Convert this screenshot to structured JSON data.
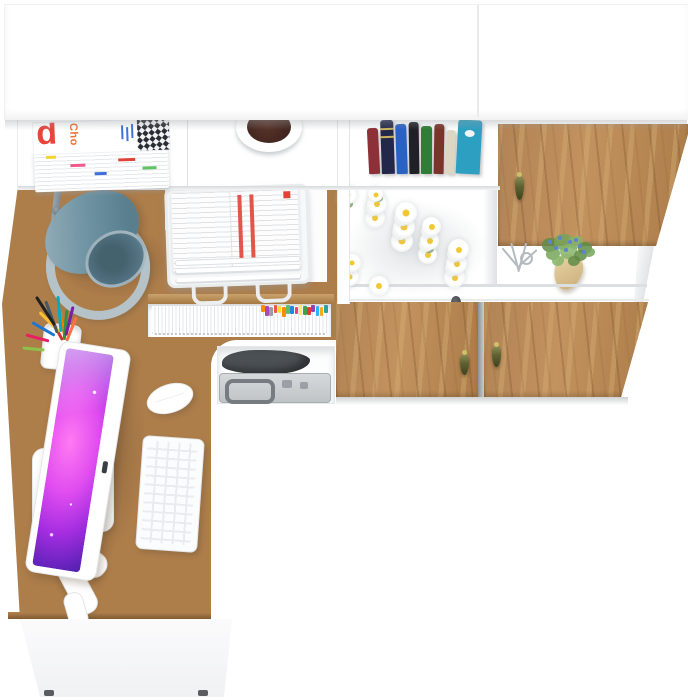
{
  "scene": {
    "background": "#ffffff",
    "floor": "#ffffff"
  },
  "palette": {
    "wood_base": "#ad7d4a",
    "wood_light": "#cda471",
    "wood_dark": "#8a5f33",
    "furniture_white": "#ffffff",
    "edge_gray": "#e3e6e8",
    "shadow_gray": "#c9cccf",
    "seam_dark": "#9b9ea1"
  },
  "magazines": {
    "big_letter": "d",
    "title_text": "Cho",
    "letter_color": "#e8443a",
    "title_color": "#ef6f2e",
    "fine_text_color": "#3f71d8",
    "checker_dark": "#2a2d33",
    "checker_light": "#f2f3f5",
    "edge_chip_colors": [
      "#f6d32d",
      "#ef5a8a",
      "#3f71d8",
      "#e04438",
      "#62c262"
    ]
  },
  "planter": {
    "pot_color": "#ffffff",
    "soil_color": "#46281f"
  },
  "books": {
    "spines": [
      {
        "color": "#8e3038"
      },
      {
        "color": "#23284a",
        "bands": true
      },
      {
        "color": "#2a62c4"
      },
      {
        "color": "#202126"
      },
      {
        "color": "#2f7d36"
      },
      {
        "color": "#79352a"
      },
      {
        "color": "#ddd6c2"
      },
      {
        "color": "#2d9fc0",
        "emblem": true
      }
    ]
  },
  "doors": {
    "pull_color": "#5d6130",
    "pull_screw": "#cdc06a",
    "seam_color": "#9b9ea1"
  },
  "shelf_decor": {
    "twig_color": "#b4bac0",
    "plant_leaf_colors": [
      "#5f8c48",
      "#74a45b",
      "#86b46a"
    ],
    "plant_flower_color": "#5d82d6",
    "plant_pot_color": "#dcc490",
    "knob_color": "#45484c"
  },
  "file_rack": {
    "folder_edge": "#e4e7e9",
    "tab_colors": [
      "#fb8c00",
      "#ab47bc",
      "#9e9e9e",
      "#ef5350",
      "#fdd835",
      "#fb8c00",
      "#66bb6a",
      "#1e88e5",
      "#ec407a",
      "#ffee58",
      "#43a047",
      "#e53935",
      "#8e44ad",
      "#29b6f6",
      "#ffa726",
      "#26a69a"
    ]
  },
  "compartment": {
    "case_color": "#c7cbce",
    "case_handle": "#767c81",
    "bag_color": "#4b5055"
  },
  "lamp": {
    "shade_color": "#6d92a1",
    "shade_light": "#93adb8",
    "shade_inner": "#44616e",
    "base_ring": "#b5c2c7",
    "stem": "#8a9499"
  },
  "document_tray": {
    "paper_color": "#fdfdfd",
    "accent_red": "#e04438",
    "wire_color": "#eceeef"
  },
  "pencil_cup": {
    "cup_color": "#ffffff",
    "pencil_colors": [
      "#d32f2f",
      "#f57c00",
      "#fbc02d",
      "#388e3c",
      "#1976d2",
      "#7b1fa2",
      "#e91e63",
      "#00acc1",
      "#455a64",
      "#8bc34a",
      "#ff7043",
      "#212121"
    ]
  },
  "flowers": {
    "petal_color": "#ffffff",
    "center_color": "#f2c832",
    "leaf_color": "#6f9c53",
    "count": 26
  },
  "computer": {
    "body_color": "#ffffff",
    "slot_color": "#3a3f44",
    "screen_colors": [
      "#ff7af2",
      "#e14df0",
      "#a32de0",
      "#5b21b6",
      "#2a1670"
    ]
  },
  "keyboard": {
    "body_color": "#fbfcfd",
    "key_gap_color": "#e9ecee"
  },
  "mouse": {
    "body_color": "#ffffff"
  }
}
